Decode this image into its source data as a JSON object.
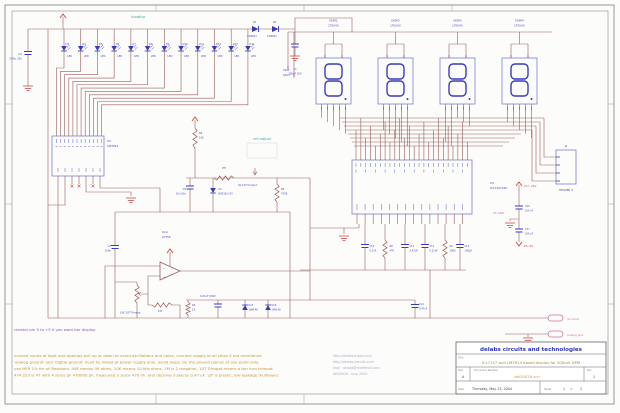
{
  "palette": {
    "wire": "#9a5b5b",
    "component_blue": "#3a3ac0",
    "label_blue": "#4545c5",
    "box_blue": "#7d7dd0",
    "power_red": "#cc4040",
    "cyan": "#3aabab",
    "pink": "#d06fa8",
    "magenta": "#b050b8",
    "notes_orange": "#c8913f",
    "note_purple": "#8b55b5",
    "title_blue": "#2d35b5",
    "title_olive": "#a38a3a",
    "links_gray": "#a8aec9",
    "frame_gray": "#8c8c8c",
    "background": "#fcfcfa"
  },
  "section_labels": {
    "loading": "loading",
    "ref_adjust": "ref adjust"
  },
  "led_bar": {
    "value_label": "LED",
    "refs": [
      "D3",
      "D4",
      "D5",
      "D6",
      "D7",
      "D8",
      "D9",
      "D10",
      "D11",
      "D12",
      "D13",
      "D14"
    ],
    "ic": {
      "ref": "U2",
      "part": "LM3914"
    },
    "note": "resistor pin 9 to +5 if you want bar display."
  },
  "supply": {
    "d1": {
      "ref": "D1",
      "part": "1N4007"
    },
    "d2": {
      "ref": "D2",
      "part": "1N4007"
    },
    "c2": {
      "ref": "C2",
      "value": "100u 25v"
    },
    "c1": {
      "ref": "C1",
      "value": "100uF 25V"
    }
  },
  "ref_adjust": {
    "r_top": {
      "ref": "R4",
      "value": "10K"
    },
    "pot_label": "pot",
    "trimpot": {
      "value": "4K 10T trimpot"
    },
    "cap": {
      "ref": "C5",
      "value": "10u 63v"
    },
    "vref": {
      "ref": "U3",
      "part": "LM336-2.5V"
    },
    "r_right": {
      "ref": "R5",
      "value": "470E"
    }
  },
  "buffer": {
    "ref": "U1A",
    "part": "LF356",
    "trimpot": {
      "value": "10K 10T Trimpot"
    },
    "r1m": {
      "value": "1M"
    },
    "r1k": {
      "ref": "R3",
      "value": "1K"
    },
    "c_in": {
      "ref": "C3",
      "value": "100n"
    },
    "c_hf": {
      "value": "0.01uF 630V"
    },
    "d_a": {
      "ref": "D15",
      "part": "1N4148"
    },
    "d_b": {
      "ref": "D16",
      "part": "1N4148"
    }
  },
  "adc": {
    "ref": "U5",
    "part": "ICL7107CPL",
    "parts": [
      {
        "ref": "C10",
        "value": "0.1uF"
      },
      {
        "ref": "R8",
        "value": "47K"
      },
      {
        "ref": "C11",
        "value": "0.47uF"
      },
      {
        "ref": "C12",
        "value": "0.22uF"
      },
      {
        "ref": "R9",
        "value": "100K"
      },
      {
        "ref": "C13",
        "value": "100pF"
      },
      {
        "ref": "C14",
        "value": "0.47uF"
      }
    ]
  },
  "displays": {
    "part": "LTS543",
    "refs": [
      "DISP1",
      "DISP2",
      "DISP3",
      "DISP4"
    ],
    "half": {
      "l1": "HALF",
      "l2": "DIGIT"
    }
  },
  "connector": {
    "ref": "J2",
    "part": "HEADER 4"
  },
  "psu": {
    "vcc": "Vcc +5V",
    "gnd": "PS GND",
    "neg": "PS -5V",
    "c_top": {
      "ref": "C16",
      "value": "100 nF"
    },
    "c_bot": {
      "ref": "C17",
      "value": "100 nF"
    }
  },
  "ports": {
    "input": "dc input",
    "agnd": "analog gnd"
  },
  "notes": [
    "unused inputs of logic and opamps pull up or down to avoid oscillations and noise, connect supply of all chips if not mentioned.",
    "'analog ground' and 'digital ground' must be linked at power supply only, avoid loops, tie the ground planes at one point only.",
    "use MFR 1% for all Resistors, 49E means 49 ohms, 10K means 10 kilo ohms, 1M is 1 megohm, 10T Trimpot means a ten turn trimpot.",
    "474 223 is 47 with 4 zeros pF 470000 pF, measured 3 zeros 470 nF, and decimal 3 places 0.47 uF, 'pf' is plastic, low leakage multilayer."
  ],
  "links": [
    "http://delabs.tripod.com",
    "http://delabs-circuits.com",
    "mail : delabs@rediffmail.com",
    "del20029 - may 2004"
  ],
  "titleblock": {
    "company": "delabs circuits and technologies",
    "title_label": "Title",
    "title": "ICL7107 and LM3914 based display for 200mV DPM",
    "size_label": "Size",
    "size": "A",
    "doc_label": "Document Number",
    "doc": "del20029.sch",
    "rev_label": "Rev",
    "rev": "1",
    "date_label": "Date:",
    "date": "Thursday, May 13, 2004",
    "sheet_label": "Sheet",
    "sheet": "1",
    "of": "of",
    "total": "1"
  }
}
